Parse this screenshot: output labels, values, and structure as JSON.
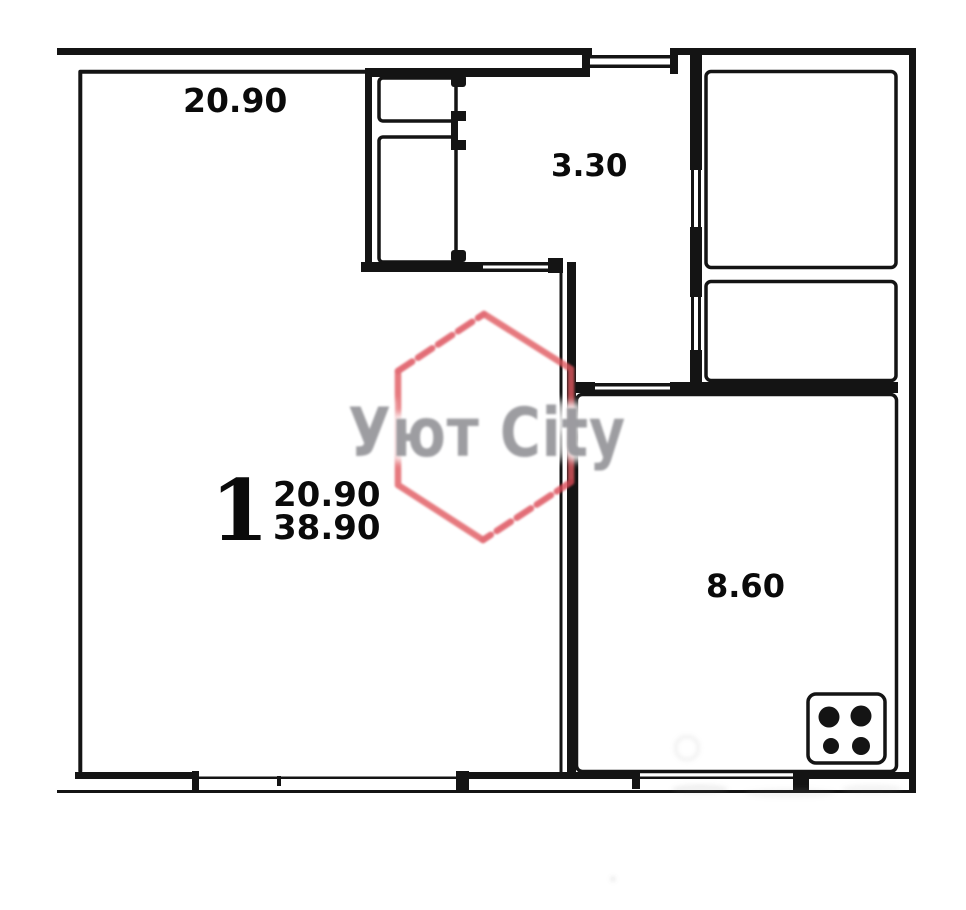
{
  "plan": {
    "kind": "apartment floor plan"
  },
  "rooms": [
    {
      "name": "living-room",
      "area_label": "20.90"
    },
    {
      "name": "hallway",
      "area_label": "3.30"
    },
    {
      "name": "kitchen",
      "area_label": "8.60"
    }
  ],
  "summary": {
    "room_count": "1",
    "living_area": "20.90",
    "total_area": "38.90"
  },
  "watermark": {
    "text": "Уют City",
    "hexagon_color": "#e0585f",
    "text_color": "#95959a"
  },
  "icons": [
    {
      "name": "stove-icon",
      "burners": 4
    }
  ],
  "colors": {
    "walls": "#141414",
    "background": "#ffffff"
  }
}
